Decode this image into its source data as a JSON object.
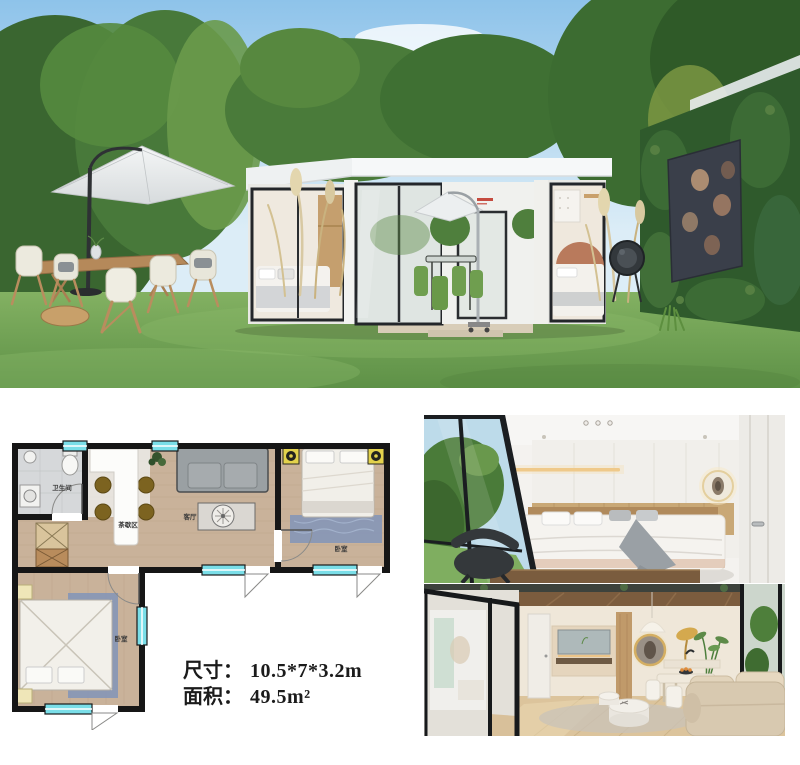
{
  "specs": {
    "dimensions_label": "尺寸：",
    "dimensions_value": "10.5*7*3.2m",
    "area_label": "面积：",
    "area_value": "49.5m²"
  },
  "floor_plan": {
    "rooms": {
      "bathroom": "卫生间",
      "tea_dining": "茶歇区",
      "living": "客厅",
      "bedroom_right": "卧室",
      "bedroom_left": "卧室"
    },
    "wall_color": "#161616",
    "window_color": "#7adee8"
  },
  "palette": {
    "sky": "#8ec3ea",
    "lawn": "#6fa356",
    "house_white": "#f2f3f1",
    "wood_floor": "#c9b29a",
    "terracotta_arch": "#b97a5c",
    "patio_chair_green": "#6f9e4f",
    "plan_rug_blue": "#8194b8",
    "plan_chair_brown": "#7c6320"
  }
}
